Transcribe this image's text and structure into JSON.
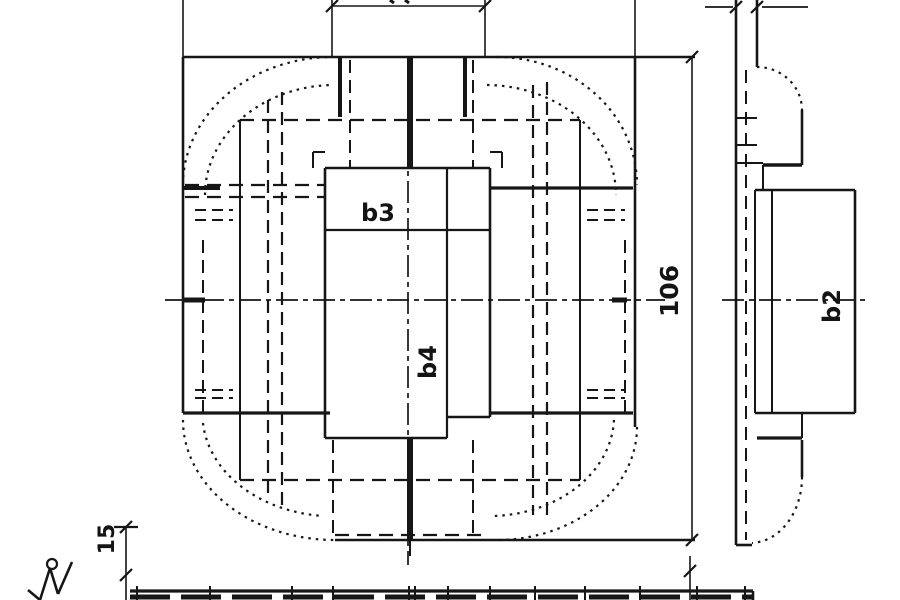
{
  "meta": {
    "description": "Scanned technical casting drawing, two views plus partial bottom view",
    "bg_color": "#ffffff",
    "ink_color": "#161616",
    "width": 900,
    "height": 600
  },
  "labels": [
    {
      "id": "dim-b3",
      "text": "b3",
      "x": 378,
      "y": 221,
      "rotate": 0,
      "size": 24
    },
    {
      "id": "dim-b4",
      "text": "b4",
      "x": 436,
      "y": 362,
      "rotate": -90,
      "size": 24
    },
    {
      "id": "dim-106",
      "text": "106",
      "x": 678,
      "y": 291,
      "rotate": -90,
      "size": 25
    },
    {
      "id": "dim-b2",
      "text": "b2",
      "x": 840,
      "y": 306,
      "rotate": -90,
      "size": 24
    },
    {
      "id": "dim-15",
      "text": "15",
      "x": 114,
      "y": 539,
      "rotate": -90,
      "size": 22
    }
  ],
  "geometry": {
    "solid": [
      [
        183,
        0,
        183,
        57,
        1.6
      ],
      [
        183,
        57,
        183,
        413,
        2.6
      ],
      [
        183,
        57,
        695,
        57,
        2.6
      ],
      [
        635,
        0,
        635,
        57,
        1.6
      ],
      [
        635,
        57,
        635,
        427,
        2.6
      ],
      [
        183,
        413,
        330,
        413,
        3.2
      ],
      [
        335,
        540,
        695,
        540,
        2.6
      ],
      [
        325,
        168,
        490,
        168,
        2.6
      ],
      [
        325,
        168,
        325,
        438,
        2.6
      ],
      [
        490,
        168,
        490,
        417,
        2.6
      ],
      [
        325,
        230,
        490,
        230,
        2.2
      ],
      [
        447,
        168,
        447,
        438,
        2.2
      ],
      [
        325,
        438,
        447,
        438,
        2.6
      ],
      [
        447,
        417,
        490,
        417,
        2.6
      ],
      [
        313,
        152,
        325,
        152,
        2
      ],
      [
        313,
        152,
        313,
        168,
        2
      ],
      [
        490,
        152,
        502,
        152,
        2
      ],
      [
        502,
        152,
        502,
        168,
        2
      ],
      [
        340,
        57,
        340,
        117,
        4
      ],
      [
        410,
        57,
        410,
        168,
        6
      ],
      [
        465,
        57,
        465,
        117,
        4
      ],
      [
        410,
        438,
        410,
        540,
        6
      ],
      [
        410,
        540,
        410,
        556,
        2
      ],
      [
        490,
        188,
        633,
        188,
        3.2
      ],
      [
        490,
        413,
        633,
        413,
        3.2
      ],
      [
        183,
        188,
        220,
        188,
        4
      ],
      [
        183,
        300,
        205,
        300,
        5
      ],
      [
        612,
        300,
        627,
        300,
        5
      ],
      [
        240,
        120,
        240,
        480,
        2
      ],
      [
        580,
        120,
        580,
        480,
        2
      ],
      [
        736,
        0,
        736,
        545,
        2.6
      ],
      [
        757,
        0,
        757,
        67,
        2.6
      ],
      [
        802,
        110,
        802,
        165,
        2.6
      ],
      [
        763,
        165,
        802,
        165,
        3.6
      ],
      [
        763,
        165,
        763,
        190,
        2
      ],
      [
        755,
        190,
        855,
        190,
        2.6
      ],
      [
        855,
        190,
        855,
        413,
        2.6
      ],
      [
        755,
        413,
        855,
        413,
        2.6
      ],
      [
        755,
        190,
        755,
        413,
        2
      ],
      [
        772,
        190,
        772,
        413,
        2
      ],
      [
        802,
        413,
        802,
        438,
        2
      ],
      [
        757,
        438,
        802,
        438,
        3.2
      ],
      [
        802,
        440,
        802,
        477,
        2.6
      ],
      [
        736,
        545,
        752,
        545,
        2.6
      ],
      [
        736,
        118,
        757,
        118,
        2
      ],
      [
        736,
        145,
        757,
        145,
        2
      ],
      [
        736,
        163,
        763,
        163,
        2
      ],
      [
        705,
        7,
        733,
        7,
        1.8
      ],
      [
        762,
        7,
        808,
        7,
        1.8
      ],
      [
        332,
        6,
        485,
        6,
        1.6
      ],
      [
        332,
        0,
        332,
        57,
        1.6
      ],
      [
        485,
        0,
        485,
        57,
        1.6
      ],
      [
        390,
        0,
        394,
        3,
        3
      ],
      [
        405,
        0,
        409,
        3,
        3
      ],
      [
        692,
        57,
        692,
        540,
        1.6
      ],
      [
        126,
        527,
        126,
        600,
        1.6
      ],
      [
        114,
        527,
        138,
        527,
        2.2
      ],
      [
        690,
        556,
        690,
        600,
        1.6
      ],
      [
        130,
        591,
        753,
        591,
        3.2
      ],
      [
        753,
        591,
        753,
        600,
        2.6
      ],
      [
        137,
        586,
        137,
        600,
        2
      ],
      [
        210,
        586,
        210,
        600,
        2
      ],
      [
        292,
        586,
        292,
        600,
        2
      ],
      [
        333,
        586,
        333,
        600,
        2
      ],
      [
        409,
        586,
        409,
        600,
        2
      ],
      [
        415,
        586,
        415,
        600,
        2
      ],
      [
        448,
        586,
        448,
        600,
        2
      ],
      [
        490,
        586,
        490,
        600,
        2
      ],
      [
        535,
        586,
        535,
        600,
        2
      ],
      [
        585,
        586,
        585,
        600,
        2
      ],
      [
        640,
        586,
        640,
        600,
        2
      ],
      [
        697,
        586,
        697,
        600,
        2
      ],
      [
        745,
        586,
        745,
        600,
        2
      ],
      [
        326,
        12,
        338,
        0,
        2.2
      ],
      [
        479,
        12,
        491,
        0,
        2.2
      ],
      [
        686,
        63,
        698,
        51,
        2.2
      ],
      [
        686,
        546,
        698,
        534,
        2.2
      ],
      [
        120,
        533,
        132,
        521,
        2.2
      ],
      [
        120,
        581,
        132,
        569,
        2.2
      ],
      [
        684,
        577,
        696,
        565,
        2.2
      ],
      [
        730,
        13,
        742,
        1,
        2.2
      ],
      [
        751,
        13,
        763,
        1,
        2.2
      ],
      [
        28,
        590,
        40,
        600,
        2.6
      ],
      [
        40,
        600,
        50,
        568,
        2.6
      ],
      [
        50,
        568,
        58,
        594,
        2.6
      ],
      [
        58,
        594,
        72,
        562,
        2.6
      ]
    ],
    "dashed": [
      [
        268,
        100,
        268,
        500,
        2.2,
        "13 7"
      ],
      [
        282,
        92,
        282,
        510,
        2.2,
        "13 7"
      ],
      [
        533,
        85,
        533,
        515,
        2.2,
        "13 7"
      ],
      [
        547,
        82,
        547,
        518,
        2.2,
        "13 7"
      ],
      [
        203,
        240,
        203,
        420,
        2,
        "13 7"
      ],
      [
        625,
        240,
        625,
        420,
        2,
        "13 7"
      ],
      [
        350,
        60,
        350,
        168,
        2,
        "13 7"
      ],
      [
        473,
        60,
        473,
        168,
        2,
        "13 7"
      ],
      [
        333,
        440,
        333,
        535,
        2,
        "13 7"
      ],
      [
        473,
        440,
        473,
        535,
        2,
        "13 7"
      ],
      [
        240,
        120,
        580,
        120,
        2.2,
        "14 8"
      ],
      [
        240,
        480,
        580,
        480,
        2.2,
        "14 8"
      ],
      [
        185,
        185,
        325,
        185,
        2.2,
        "14 8"
      ],
      [
        185,
        197,
        325,
        197,
        2.2,
        "14 8"
      ],
      [
        587,
        210,
        625,
        210,
        2,
        "11 6"
      ],
      [
        587,
        220,
        625,
        220,
        2,
        "11 6"
      ],
      [
        587,
        390,
        625,
        390,
        2,
        "11 6"
      ],
      [
        587,
        398,
        625,
        398,
        2,
        "11 6"
      ],
      [
        195,
        210,
        233,
        210,
        2,
        "11 6"
      ],
      [
        195,
        220,
        233,
        220,
        2,
        "11 6"
      ],
      [
        195,
        390,
        233,
        390,
        2,
        "11 6"
      ],
      [
        195,
        398,
        233,
        398,
        2,
        "11 6"
      ],
      [
        335,
        535,
        485,
        535,
        2.2,
        "14 8"
      ],
      [
        746,
        70,
        746,
        540,
        2,
        "13 8"
      ],
      [
        130,
        597,
        753,
        597,
        5,
        "40 11"
      ]
    ],
    "dashdot": [
      [
        165,
        300,
        665,
        300,
        1.7,
        "22 5 5 5"
      ],
      [
        408,
        70,
        408,
        565,
        1.7,
        "22 5 5 5"
      ],
      [
        722,
        300,
        870,
        300,
        1.7,
        "22 5 5 5"
      ]
    ],
    "dotted_paths": [
      "M183,185 A150,128 0 0 1 333,57",
      "M205,195 A130,110 0 0 1 333,85",
      "M497,57 A140,128 0 0 1 637,185",
      "M487,85 A130,110 0 0 1 616,195",
      "M183,420 A152,120 0 0 0 335,540",
      "M203,423 A132,102 0 0 0 323,516",
      "M637,427 A140,113 0 0 1 497,540",
      "M614,420 A125,100 0 0 1 493,516",
      "M757,67 A45,43 0 0 1 802,110",
      "M802,477 A52,66 0 0 1 752,543"
    ],
    "circles": [
      [
        52,
        564,
        5,
        2.2
      ]
    ]
  }
}
